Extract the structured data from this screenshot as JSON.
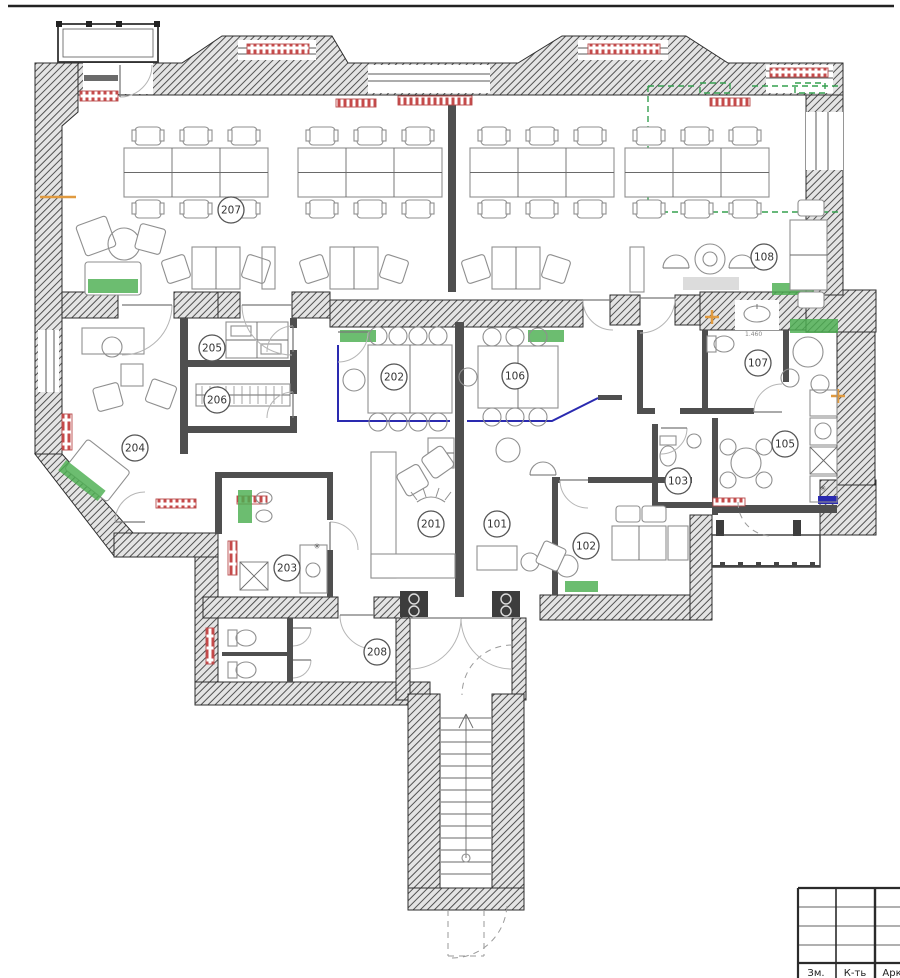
{
  "plan": {
    "kind": "architectural office floor plan",
    "rooms": [
      {
        "id": "207",
        "x": 231,
        "y": 210
      },
      {
        "id": "108",
        "x": 764,
        "y": 257
      },
      {
        "id": "205",
        "x": 212,
        "y": 348
      },
      {
        "id": "206",
        "x": 217,
        "y": 400
      },
      {
        "id": "202",
        "x": 394,
        "y": 377
      },
      {
        "id": "106",
        "x": 515,
        "y": 376
      },
      {
        "id": "107",
        "x": 758,
        "y": 363
      },
      {
        "id": "204",
        "x": 135,
        "y": 448
      },
      {
        "id": "105",
        "x": 785,
        "y": 444
      },
      {
        "id": "103",
        "x": 678,
        "y": 481
      },
      {
        "id": "201",
        "x": 431,
        "y": 524
      },
      {
        "id": "101",
        "x": 497,
        "y": 524
      },
      {
        "id": "102",
        "x": 586,
        "y": 546
      },
      {
        "id": "203",
        "x": 287,
        "y": 568
      },
      {
        "id": "208",
        "x": 377,
        "y": 652
      }
    ],
    "title_block": {
      "columns": [
        "Зм.",
        "К-ть",
        "Арк"
      ]
    },
    "annotations": {
      "sink_dimension": "1.460"
    },
    "colors": {
      "wall_hatch": "#4a4a4a",
      "accent_green": "#4caf50",
      "accent_red": "#c64a4a",
      "accent_blue": "#2a2ab0",
      "accent_orange": "#e09a40",
      "dashed_green": "#35a04f"
    }
  }
}
